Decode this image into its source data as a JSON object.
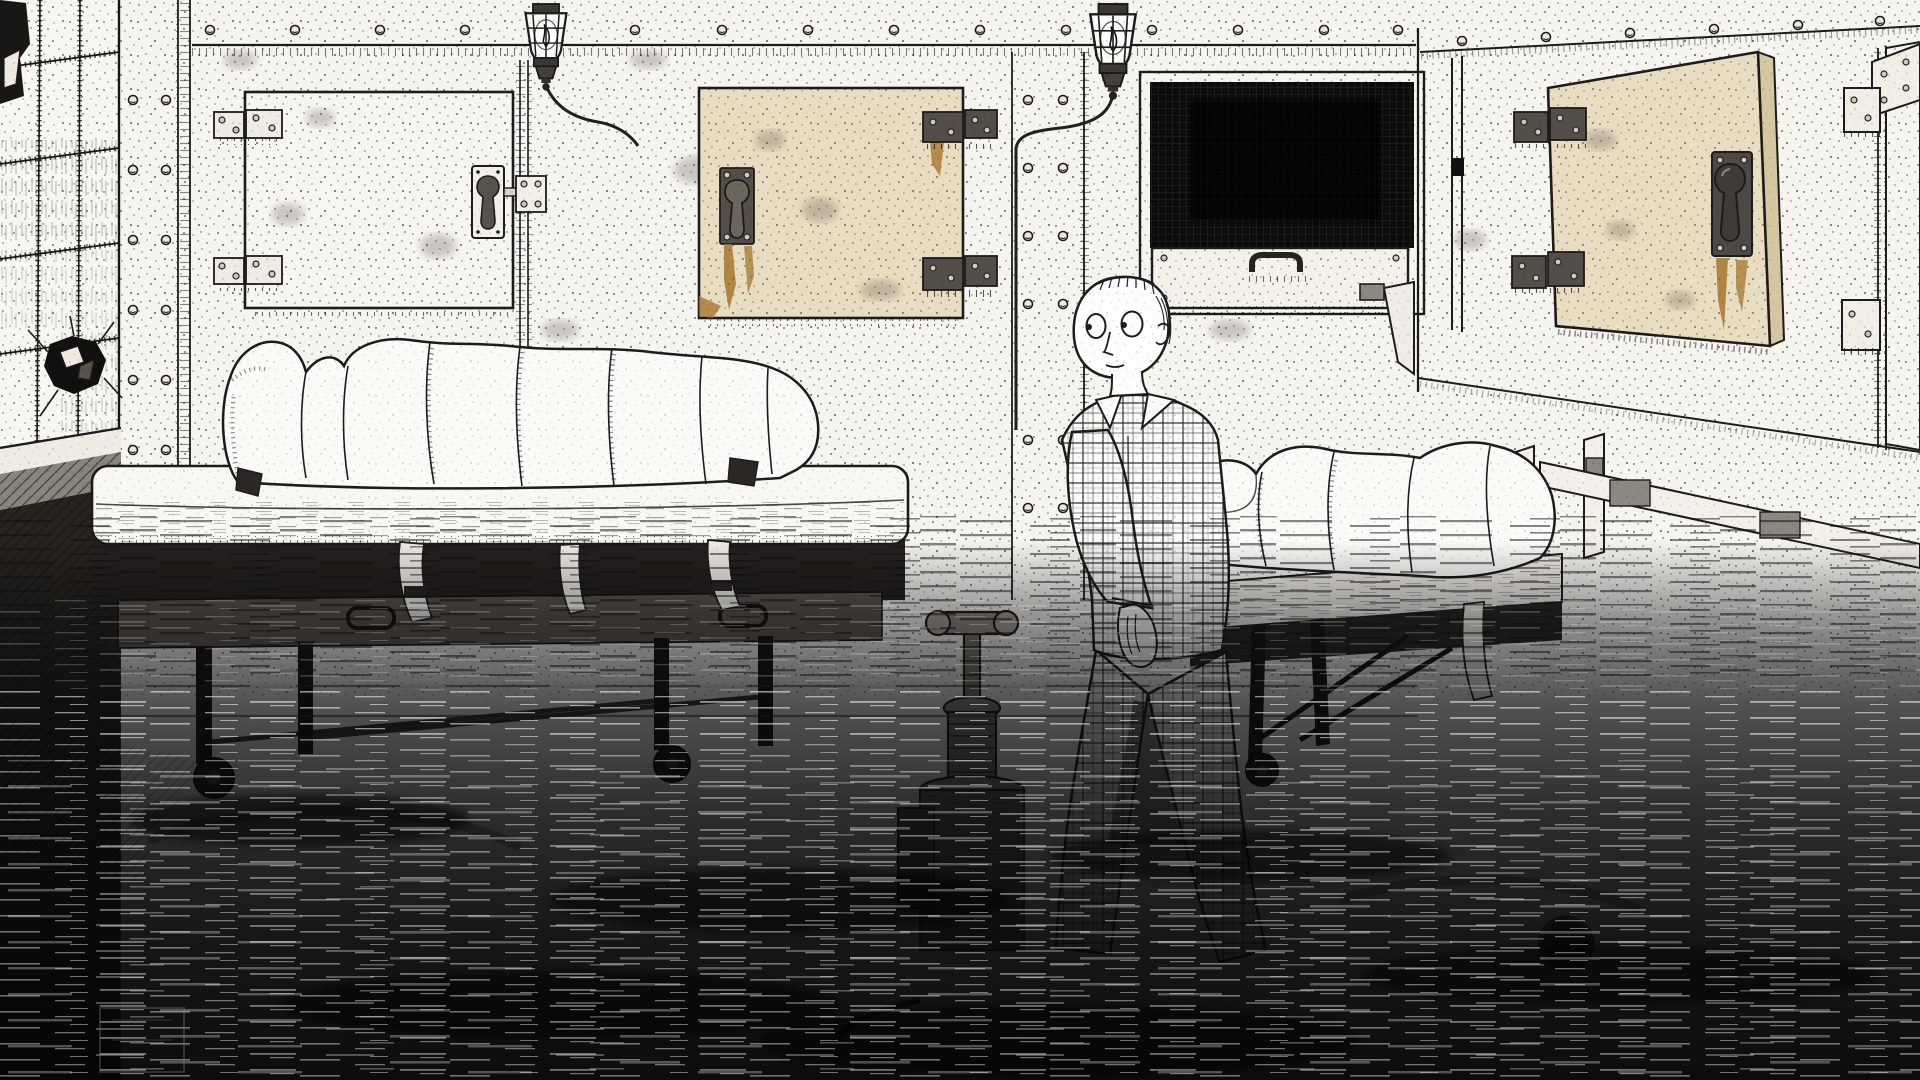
{
  "meta": {
    "domain": "game-scene",
    "description": "Monochrome hand-drawn horror game scene: a morgue room with riveted metal walls, body-freezer doors, two gurneys holding sheet-wrapped corpses, and a man in plaid pajamas wading through a dark flooded floor"
  },
  "palette": {
    "paper": "#f6f4ef",
    "ink": "#1c1c1c",
    "tan": "#e9ddc1",
    "tanEdge": "#d6c7a3",
    "rust": "#a6772f",
    "rustDark": "#7c5a22",
    "metalDark": "#534e48",
    "metalLight": "#efece5",
    "interior": "#0b0b0b",
    "frame": "#24211e",
    "waterDeep": "#050505",
    "silhouette": "#8f8a82"
  },
  "scene": {
    "elements": [
      {
        "id": "tiled-wall",
        "label": "cracked tile wall with smashed hole"
      },
      {
        "id": "morgue-door-left",
        "label": "closed white freezer door with hinges and pull handle"
      },
      {
        "id": "morgue-door-center",
        "label": "closed tan freezer door with rust stains"
      },
      {
        "id": "morgue-compartment-open",
        "label": "open body compartment, dark interior, pull-out tray"
      },
      {
        "id": "morgue-door-open",
        "label": "tan freezer door swung open"
      },
      {
        "id": "morgue-door-right",
        "label": "partial freezer door on right wall"
      },
      {
        "id": "wall-lamp-1",
        "label": "caged wall lamp"
      },
      {
        "id": "wall-lamp-2",
        "label": "caged wall lamp"
      },
      {
        "id": "gurney-left",
        "label": "wheeled gurney with wrapped body"
      },
      {
        "id": "gurney-right",
        "label": "wheeled gurney with wrapped body, half submerged"
      },
      {
        "id": "hydraulic-pump",
        "label": "hydraulic pump standing in the water"
      },
      {
        "id": "player-character",
        "label": "man in plaid pajamas walking left"
      },
      {
        "id": "flood-water",
        "label": "dark scratched flood water covering the floor"
      }
    ]
  }
}
